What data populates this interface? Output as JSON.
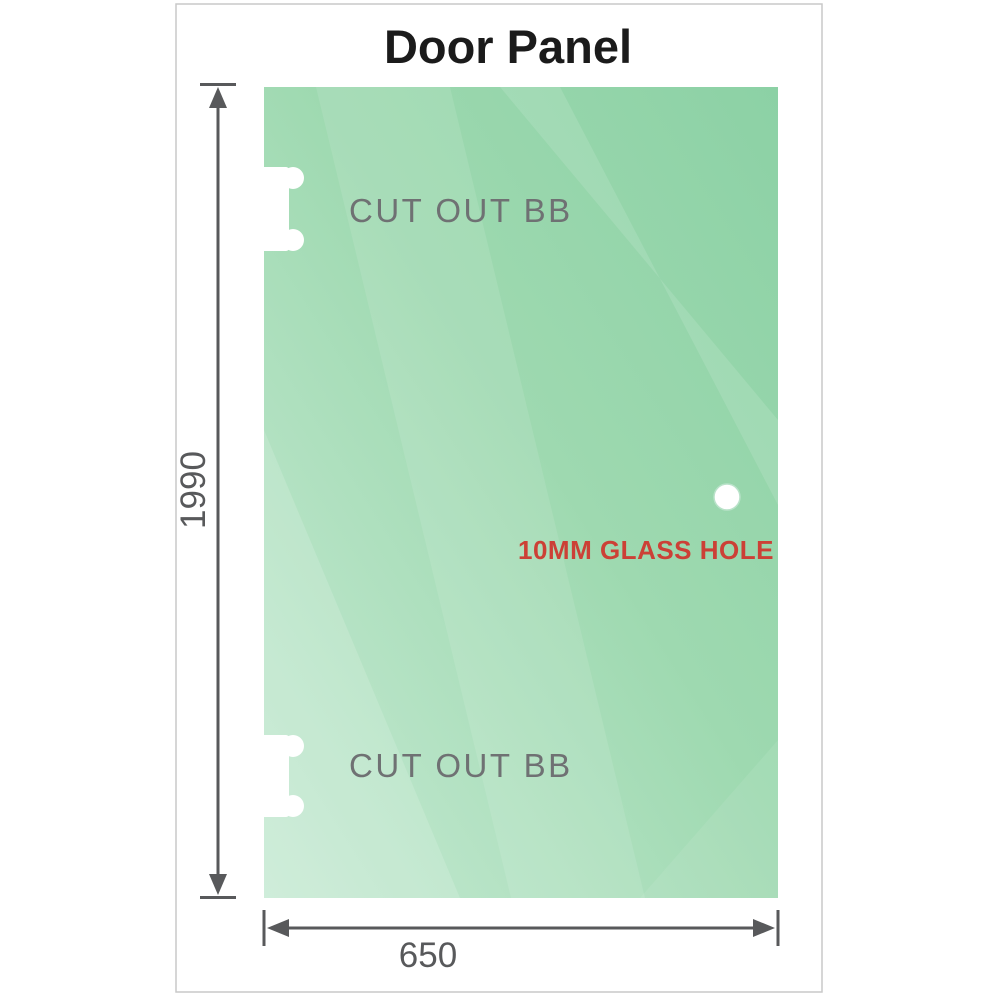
{
  "title": "Door Panel",
  "panel": {
    "cutout_top_label": "CUT OUT BB",
    "cutout_bottom_label": "CUT OUT BB",
    "hole_label": "10MM GLASS HOLE"
  },
  "dimensions": {
    "height": "1990",
    "width": "650"
  },
  "colors": {
    "glass_green_dark": "#8cd1a5",
    "glass_green_mid": "#9ed9b0",
    "glass_green_light": "#c7ead4",
    "dimension_gray": "#58595b",
    "cutout_label_gray": "#6f7173",
    "hole_label_red": "#cc4036",
    "title_color": "#1b1b1b",
    "frame_gray": "#c9c9c9"
  }
}
